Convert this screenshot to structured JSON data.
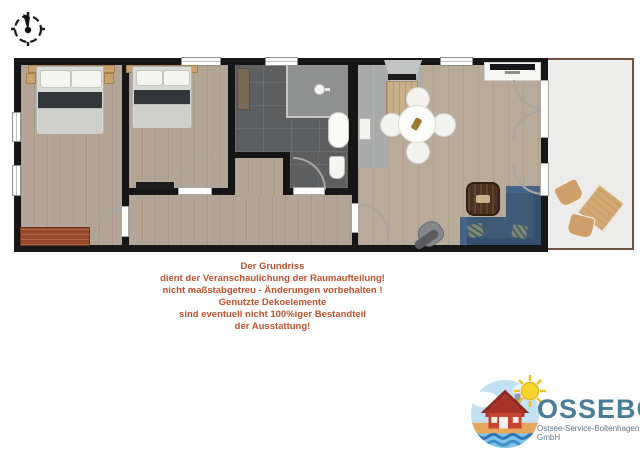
{
  "disclaimer": {
    "lines": [
      "Der Grundriss",
      "dient der Veranschaulichung der Raumaufteilung!",
      "nicht maßstabgetreu - Änderungen vorbehalten !",
      "Genutzte Dekoelemente",
      "sind eventuell nicht 100%iger Bestandteil",
      "der Ausstattung!"
    ]
  },
  "logo": {
    "title": "OSSEBO",
    "subtitle": "Ostsee-Service-Boltenhagen GmbH"
  },
  "icons": {
    "compass": "compass-icon",
    "shower": "shower-head-icon",
    "sun": "sun-icon",
    "house": "house-icon"
  },
  "colors": {
    "wall": "#161616",
    "floor_wood": "#b3a596",
    "floor_wood_light": "#b9ab9a",
    "tile_dark": "#5c5e60",
    "tile_light": "#909292",
    "kitchen_gray": "#a9abaa",
    "terrace_floor": "#ecedea",
    "terrace_border": "#6f5242",
    "sofa": "#3e5a77",
    "sofa_dark": "#35506b",
    "dresser": "#96482b",
    "bed_band": "#33373c",
    "counter_wood": "#c9b08a",
    "coffee_table": "#4b3322",
    "pillow_green": "#7d8a80",
    "accent_text": "#c0522d",
    "logo_blue": "#4a7d99",
    "logo_gray": "#5f7585"
  }
}
